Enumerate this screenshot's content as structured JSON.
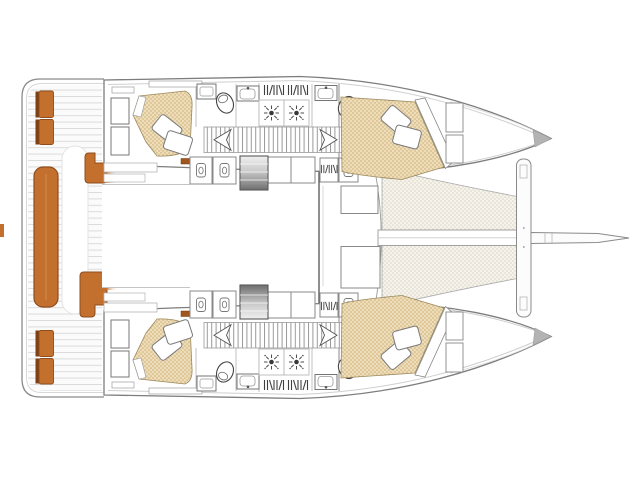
{
  "document": {
    "type": "boat-floor-plan",
    "subject": "Sailing catamaran accommodation and deck layout, top-down view, bow to the right",
    "visible_text": []
  },
  "colors": {
    "background": "#ffffff",
    "outline_dark": "#555555",
    "outline_mid": "#8a8a8a",
    "outline_light": "#cccccc",
    "seat_orange": "#c3702e",
    "seat_orange_dark": "#8f4c1d",
    "seat_back_brown": "#7c4015",
    "seat_fade": "#c3702e",
    "handle_orange": "#a1561e",
    "deck_base": "#fbfbfb",
    "deck_line": "#dcdcdc",
    "bed_base": "#edddb9",
    "bed_dot": "#c9a86e",
    "bed_edge": "#9b8a5e",
    "tramp_base": "#f6f3ec",
    "tramp_dot": "#d8d1be",
    "steps_light": "#f0f0f0",
    "steps_dark": "#6e6e6e",
    "bow_tip_gray": "#b3b3b3",
    "room_fill": "#ffffff"
  },
  "features": {
    "aft_cockpit": {
      "deck": "teak plank deck",
      "bench_seat": "full-width aft bench seat",
      "transom_seats": "twin seat modules on each transom",
      "side_seats": "two L-shaped seats at saloon entrance"
    },
    "port_hull": {
      "aft_cabin": "double berth with two pillows and wardrobe",
      "aft_head": "toilet and washbasin",
      "galley": "two-burner stove, sink, louvered lockers",
      "companionway": "steps down from saloon",
      "corridor": "hatched passageway with chevron ends",
      "forward_head": "toilet and washbasin",
      "forward_cabin": "double berth with two pillows and shelves"
    },
    "starboard_hull": "mirror image of port hull",
    "foredeck": {
      "forward_cockpit": "two forward-facing seat lockers",
      "trampoline": "netted trampoline between hulls",
      "crossbeam": "forward crossbeam",
      "bowsprit": "center bowsprit"
    }
  },
  "icons": [
    "burner-icon",
    "toilet-icon",
    "sink-icon",
    "louver-vent-icon",
    "locker-jar-icon",
    "pillow-icon",
    "steps-gradient-icon",
    "hatch-lines-icon",
    "chevron-arrow-icon"
  ]
}
